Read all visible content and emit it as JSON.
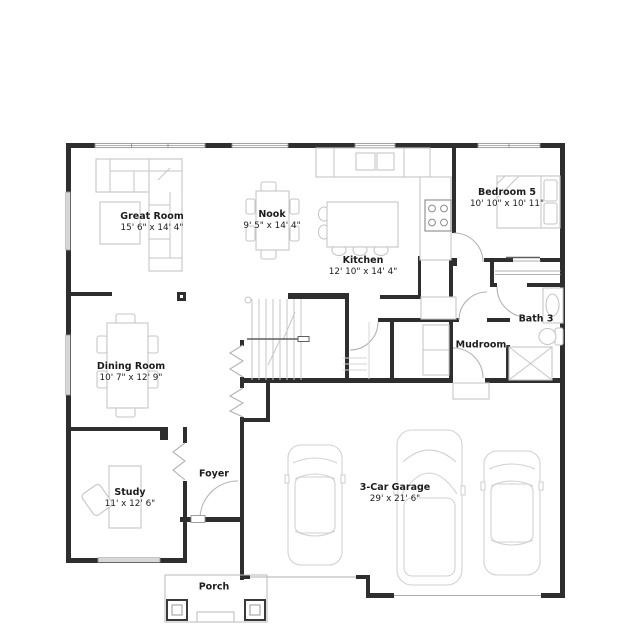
{
  "plan_type": "floor-plan",
  "rooms": {
    "great_room": {
      "name": "Great Room",
      "dims": "15' 6\" x 14' 4\""
    },
    "nook": {
      "name": "Nook",
      "dims": "9' 5\" x 14' 4\""
    },
    "kitchen": {
      "name": "Kitchen",
      "dims": "12' 10\" x 14' 4\""
    },
    "bedroom5": {
      "name": "Bedroom 5",
      "dims": "10' 10\" x 10' 11\""
    },
    "dining_room": {
      "name": "Dining Room",
      "dims": "10' 7\" x 12' 9\""
    },
    "bath3": {
      "name": "Bath 3"
    },
    "mudroom": {
      "name": "Mudroom"
    },
    "study": {
      "name": "Study",
      "dims": "11' x 12' 6\""
    },
    "foyer": {
      "name": "Foyer"
    },
    "garage": {
      "name": "3-Car Garage",
      "dims": "29' x 21' 6\""
    },
    "porch": {
      "name": "Porch"
    }
  },
  "colors": {
    "wall": "#2e2e2e",
    "furniture_line": "#c6c6c6",
    "door_swing": "#b3b3b3",
    "window": "#949494",
    "text": "#1c1c1c",
    "background": "#ffffff"
  }
}
